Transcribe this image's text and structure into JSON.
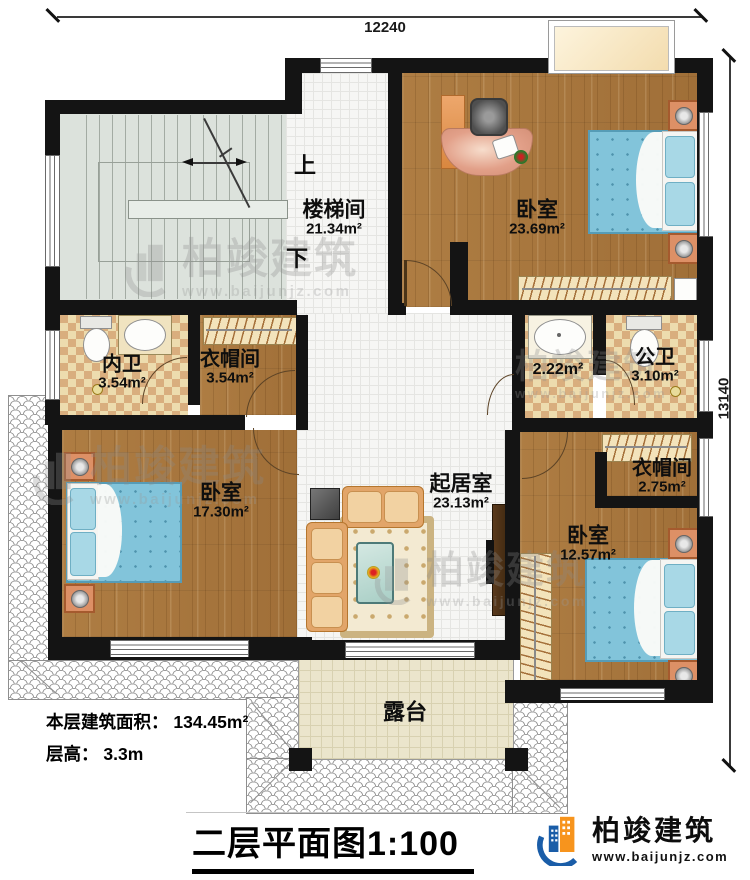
{
  "dimensions": {
    "top": "12240",
    "right": "13140"
  },
  "rooms": [
    {
      "name": "楼梯间",
      "area": "21.34m²"
    },
    {
      "name": "卧室",
      "area": "23.69m²"
    },
    {
      "name": "内卫",
      "area": "3.54m²"
    },
    {
      "name": "衣帽间",
      "area": "3.54m²"
    },
    {
      "name": "",
      "area": "2.22m²"
    },
    {
      "name": "公卫",
      "area": "3.10m²"
    },
    {
      "name": "起居室",
      "area": "23.13m²"
    },
    {
      "name": "卧室",
      "area": "17.30m²"
    },
    {
      "name": "衣帽间",
      "area": "2.75m²"
    },
    {
      "name": "卧室",
      "area": "12.57m²"
    },
    {
      "name": "露台",
      "area": ""
    }
  ],
  "stair": {
    "up": "上",
    "down": "下"
  },
  "info": {
    "line1": "本层建筑面积： 134.45m²",
    "line2": "层高： 3.3m"
  },
  "title": {
    "main": "二层平面图",
    "scale": "1:100"
  },
  "brand": {
    "name": "柏竣建筑",
    "url": "www.baijunjz.com"
  },
  "watermark": {
    "text": "柏竣建筑",
    "url": "www.baijunjz.com"
  },
  "colors": {
    "wall": "#141414",
    "wood": "#a87940",
    "tile_white": "#f6f6f4",
    "checker_light": "#eddcae",
    "checker_dark": "#d9ae7e",
    "bed_blue": "#82c4da",
    "stair_floor": "#dce2dc",
    "terrace_floor": "#ebe5cc",
    "roof_line": "#9a9a9a",
    "brand_blue": "#1a5da8",
    "brand_orange": "#f7941d"
  }
}
